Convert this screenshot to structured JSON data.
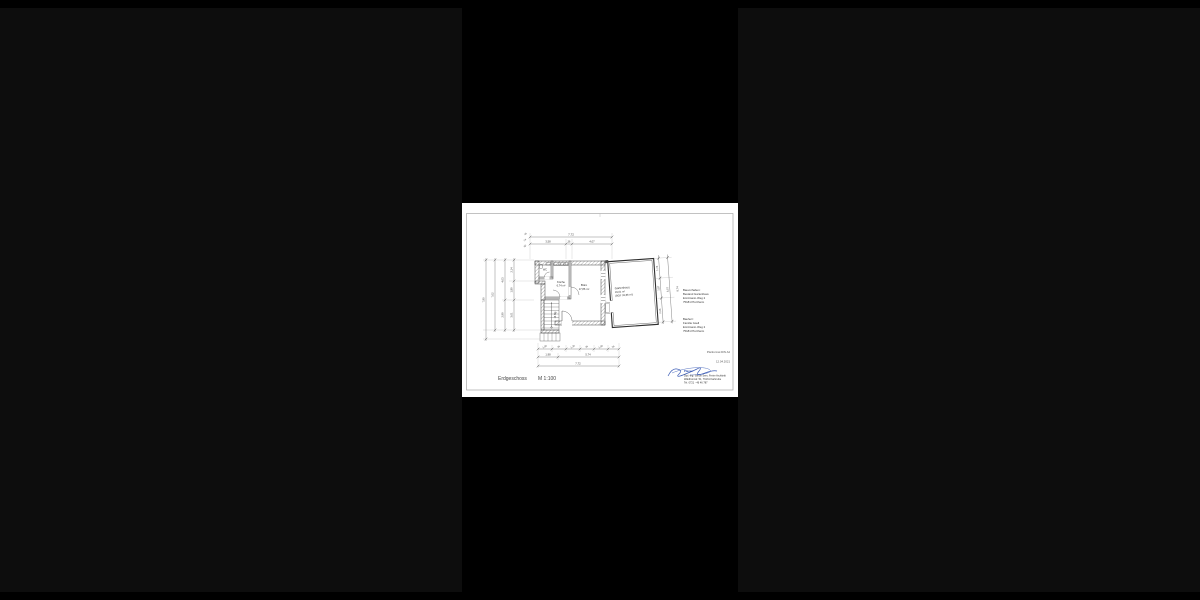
{
  "colors": {
    "background_outer": "#0d0d0d",
    "background_center": "#000000",
    "page": "#ffffff",
    "line": "#3a3a3a",
    "dim_text": "#444444",
    "signature_blue": "#2b4fb0"
  },
  "titleblock": {
    "title": "Erdgeschoss",
    "scale": "M 1:100"
  },
  "project": {
    "heading": "Bauvorhaben:",
    "line1": "Bestand Gartenhaus",
    "line2": "Emil-Gann-Weg 2",
    "line3": "75181 Pforzheim"
  },
  "client": {
    "heading": "Bauherr:",
    "line1": "Familie Gsell",
    "line2": "Emil-Gann-Weg 2",
    "line3": "75181 Pforzheim"
  },
  "meta": {
    "format": "Planformat DIN A4",
    "date": "12.04.2021"
  },
  "planner": {
    "heading": "Planer:",
    "line1": "Dipl.-Ing. Simon Sers, Freier Architekt",
    "line2": "Waldhornstr. 51, 76131 Karlsruhe",
    "line3": "Tel. 0721 - 46 46 787"
  },
  "rooms": {
    "wc": {
      "name": "WC"
    },
    "kueche": {
      "name": "Küche",
      "area": "6,74 m²"
    },
    "buero": {
      "name": "Büro",
      "area": "17,86 m²"
    },
    "gartenhaus": {
      "name": "Gartenhaus",
      "area": "29,51 m²",
      "bgf": "(BGF 33,86 m²)"
    },
    "stair": {
      "label": "14 Stg"
    }
  },
  "dimensions": {
    "top": {
      "overall": "7,72",
      "seg1": "3,58",
      "seg2": "36",
      "seg3": "4,07",
      "small1": "45",
      "small2": "24",
      "small3": "50"
    },
    "bottom": {
      "c1": [
        "1,00",
        "36",
        "1,36",
        "36",
        "1,00",
        "36"
      ],
      "c2": [
        "1,98",
        "5,74"
      ],
      "overall": "7,72"
    },
    "left": {
      "l1": [
        "2,14",
        "1,89",
        "3,01"
      ],
      "l2": [
        "4,03",
        "2,99"
      ],
      "l3": "7,02",
      "l4": "7,90"
    },
    "right": {
      "r1": [
        "1,74",
        "1,87",
        "2,26"
      ],
      "r2": "6,57",
      "r3": "8,74"
    }
  }
}
